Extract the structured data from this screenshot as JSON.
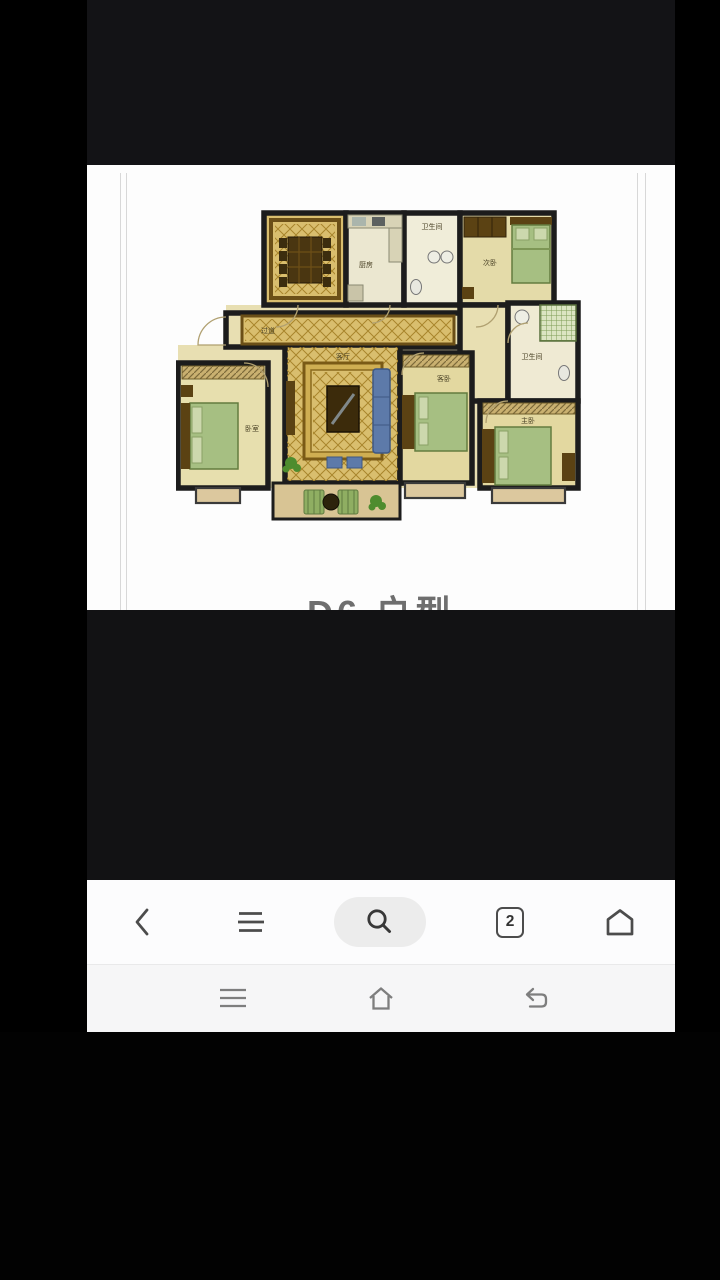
{
  "photo": {
    "caption": "D6 户型",
    "rooms": {
      "kitchen": "厨房",
      "bath_top": "卫生间",
      "bedroom_top_right": "次卧",
      "hallway": "过道",
      "bath_right": "卫生间",
      "bedroom_left": "卧室",
      "living": "客厅",
      "bedroom_mid": "客卧",
      "master_bedroom": "主卧"
    },
    "colors": {
      "wall": "#1c1c1c",
      "floor_cream": "#e8dfb2",
      "diamond_gold": "#d9be6e",
      "bed_green": "#a6bf82",
      "wood_dark": "#5b4213"
    }
  },
  "browser_toolbar": {
    "tab_count": "2",
    "notification_dot_color": "#e23b30",
    "icons": [
      "back-chevron",
      "menu-lines",
      "search-magnifier",
      "tab-counter",
      "home-outline"
    ]
  },
  "system_nav": {
    "icons": [
      "recents-lines",
      "home-house",
      "back-return"
    ]
  }
}
